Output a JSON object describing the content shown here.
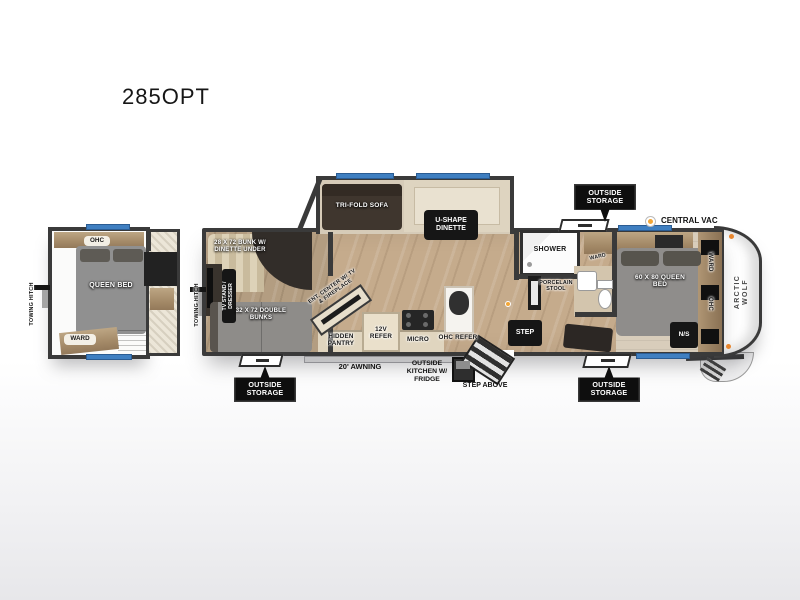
{
  "title": "285OPT",
  "colors": {
    "wall": "#3a3a3a",
    "window_blue": "#3f7fc1",
    "marker_orange": "#f2a637",
    "badge_bg": "#0e0e0e",
    "floor_wood": "#c5ab8c",
    "bed_gray": "#8f8d8b"
  },
  "inset": {
    "ohc": "OHC",
    "queen_bed": "QUEEN BED",
    "ward": "WARD",
    "towing_hitch": "TOWING HITCH"
  },
  "main": {
    "towing_hitch": "TOWING HITCH",
    "slideout": {
      "sofa": "TRI-FOLD SOFA",
      "dinette": "U-SHAPE DINETTE"
    },
    "bunk_room": {
      "bunk_dinette": "28 X 72 BUNK W/ DINETTE UNDER",
      "tv_stand": "TV STAND / DRESSER",
      "double_bunks": "32 X 72 DOUBLE BUNKS"
    },
    "living": {
      "ent_center": "ENT. CENTER W/ TV & FIREPLACE"
    },
    "kitchen": {
      "hidden_pantry": "HIDDEN PANTRY",
      "refer_12v": "12V REFER",
      "micro": "MICRO",
      "ohc_refer": "OHC REFER"
    },
    "bath": {
      "shower": "SHOWER",
      "ward": "WARD",
      "porcelain_stool": "PORCELAIN STOOL",
      "step": "STEP"
    },
    "bedroom": {
      "bed": "60 X 80 QUEEN BED",
      "ward": "WARD",
      "ohc": "OHC",
      "night_stand": "N/S"
    }
  },
  "exterior": {
    "outside_storage": "OUTSIDE STORAGE",
    "central_vac": "CENTRAL VAC",
    "awning": "20' AWNING",
    "outside_kitchen": "OUTSIDE KITCHEN W/ FRIDGE",
    "step_above": "STEP ABOVE",
    "brand": "ARCTIC WOLF"
  }
}
